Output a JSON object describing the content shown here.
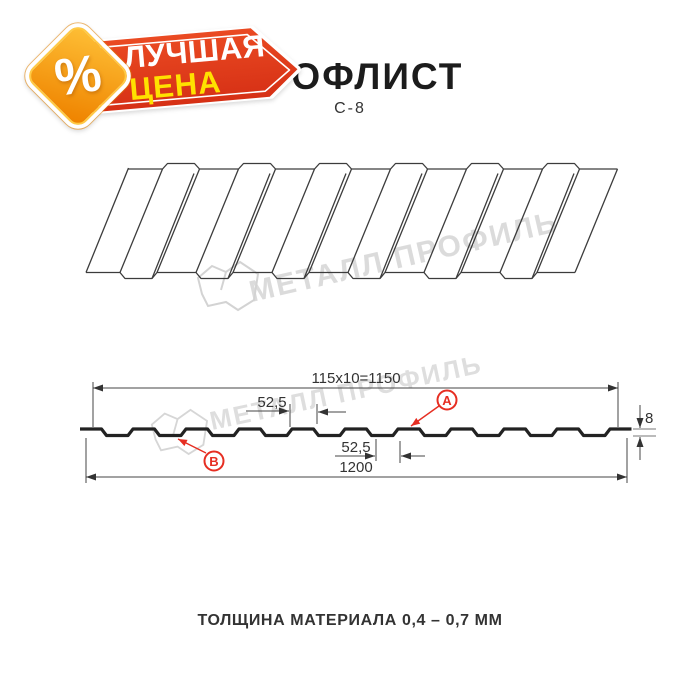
{
  "badge": {
    "percent_symbol": "%",
    "line1": "ЛУЧШАЯ",
    "line2": "ЦЕНА"
  },
  "header": {
    "title": "ПРОФЛИСТ",
    "subtitle": "C-8"
  },
  "watermark": {
    "text": "МЕТАЛЛ ПРОФИЛЬ"
  },
  "diagram": {
    "dim_working_width": "115x10=1150",
    "dim_total_width": "1200",
    "dim_pitch_top": "52,5",
    "dim_pitch_bottom": "52,5",
    "dim_height": "8",
    "label_a": "A",
    "label_b": "B"
  },
  "footer": {
    "text": "ТОЛЩИНА МАТЕРИАЛА 0,4 – 0,7 ММ"
  },
  "colors": {
    "banner_red": "#dd3917",
    "badge_orange": "#f49a06",
    "badge_yellow_text": "#ffe100",
    "annotation_red": "#e62e22",
    "watermark_gray": "#c9c9c9",
    "line_dark": "#2f2f2f"
  }
}
